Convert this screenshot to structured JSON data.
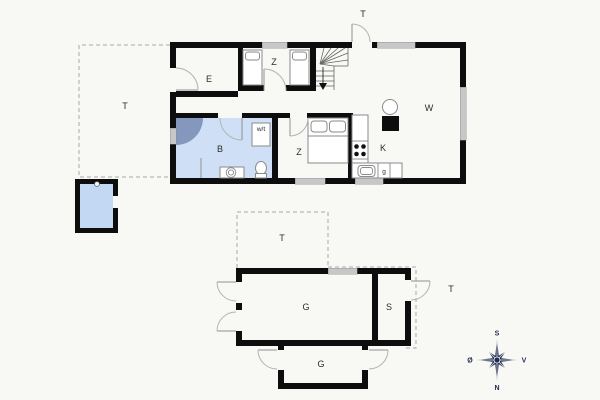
{
  "labels": {
    "entrance": "E",
    "bedroom_top": "Z",
    "bathroom": "B",
    "washer_dryer": "w/t",
    "bedroom_mid": "Z",
    "kitchen": "K",
    "appliance": "g",
    "living_room": "W",
    "terrace_left": "T",
    "terrace_top": "T",
    "terrace_garage_top": "T",
    "terrace_garage_right": "T",
    "garage_main": "G",
    "shed": "S",
    "garage_lower": "G",
    "compass_south": "S",
    "compass_west": "V",
    "compass_north": "N",
    "compass_east": "Ø"
  },
  "colors": {
    "background": "#f8f8f5",
    "wall": "#0d0d0d",
    "window": "#c7c7c7",
    "bathroom_fill": "#cfe0f6",
    "shower_fill": "#8497bd",
    "pool_fill": "#c2d8f3",
    "compass": "#1d2c4e"
  }
}
